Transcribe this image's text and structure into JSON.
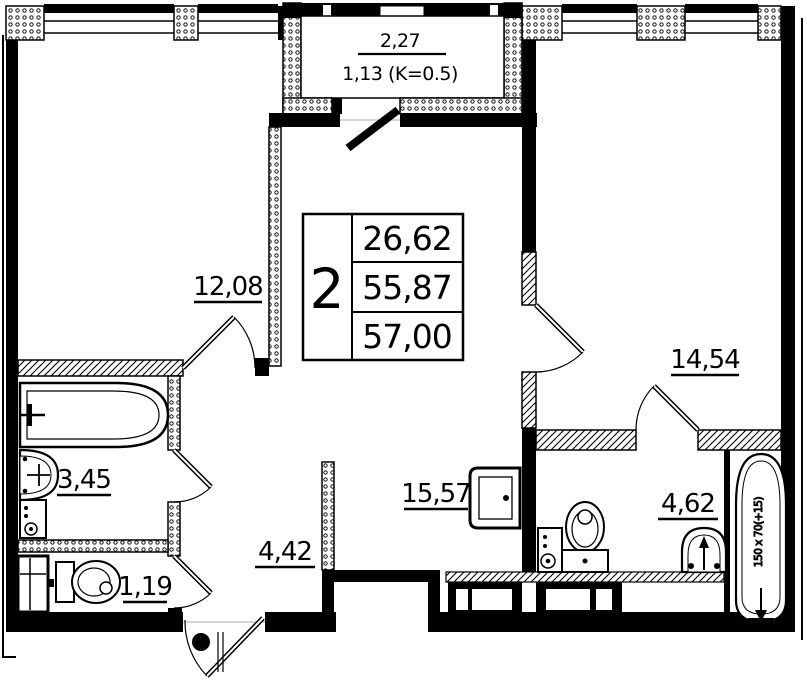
{
  "plan": {
    "summary_table": {
      "rooms_count": "2",
      "living_area": "26,62",
      "apartment_area": "55,87",
      "total_area": "57,00"
    },
    "balcony": {
      "area": "2,27",
      "area_with_coefficient": "1,13 (K=0.5)"
    },
    "room_areas": {
      "bedroom_left": "12,08",
      "bedroom_right": "14,54",
      "bathroom": "3,45",
      "wc": "1,19",
      "hallway": "4,42",
      "kitchen_living": "15,57",
      "ensuite_bathroom": "4,62"
    },
    "annotations": {
      "bathtub_size": "150 x 70(+15)"
    },
    "colors": {
      "line": "#000000",
      "background": "#ffffff"
    }
  }
}
